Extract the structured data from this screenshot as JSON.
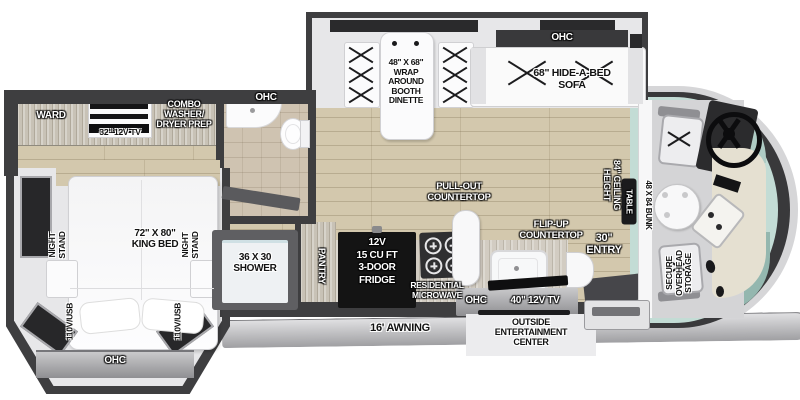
{
  "title": "Class A motorhome floor plan",
  "colors": {
    "wall": "#3e3e40",
    "floor_wood": "#d3c8ad",
    "slide_interior": "#e7e7e9",
    "cabinet_wood": "#c8c2b6",
    "accent_bar_gray": "#8f8f92",
    "fridge_black": "#141414",
    "windshield_teal": "#c3dcd5",
    "front_cap_gray": "#d6d6d8",
    "label_dark": "#121212",
    "label_light": "#ffffff"
  },
  "plan": {
    "rear_bedroom": {
      "ward": "WARD",
      "tv": "32\" 12V TV",
      "washer_dryer": [
        "COMBO",
        "WASHER/",
        "DRYER PREP"
      ],
      "night_stand": [
        "NIGHT",
        "STAND"
      ],
      "king_bed": [
        "72\" X 80\"",
        "KING BED"
      ],
      "outlet": "110V/USB",
      "ohc": "OHC"
    },
    "bathroom": {
      "ohc": "OHC",
      "shower": [
        "36 X 30",
        "SHOWER"
      ]
    },
    "kitchen": {
      "pantry": "PANTRY",
      "fridge": [
        "12V",
        "15 CU FT",
        "3-DOOR",
        "FRIDGE"
      ],
      "microwave": [
        "RESIDENTIAL",
        "MICROWAVE"
      ],
      "pullout": [
        "PULL-OUT",
        "COUNTERTOP"
      ],
      "flipup": [
        "FLIP-UP",
        "COUNTERTOP"
      ],
      "ohc": "OHC",
      "tv": "40\" 12V TV"
    },
    "living": {
      "dinette": [
        "48\" X 68\"",
        "WRAP",
        "AROUND",
        "BOOTH",
        "DINETTE"
      ],
      "sofa": [
        "68\" HIDE-A-BED",
        "SOFA"
      ],
      "sofa_ohc": "OHC"
    },
    "cab": {
      "bunk": "48 X 84 BUNK",
      "table": "TABLE",
      "ceiling": [
        "84\" CEILING",
        "HEIGHT"
      ],
      "storage": [
        "SECURE",
        "OVERHEAD",
        "STORAGE"
      ]
    },
    "entry": [
      "30\"",
      "ENTRY"
    ],
    "exterior": {
      "awning": "16' AWNING",
      "outside_entertainment": [
        "OUTSIDE",
        "ENTERTAINMENT",
        "CENTER"
      ]
    }
  }
}
